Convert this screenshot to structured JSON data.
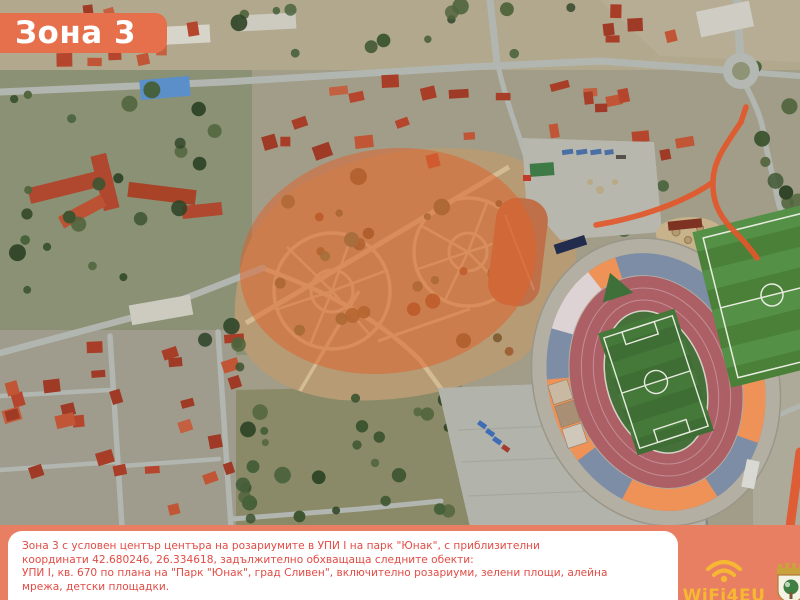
{
  "zone_banner": {
    "label": "Зона 3"
  },
  "caption": {
    "lines": [
      "Зона 3 с условен център центъра на розариумите в УПИ I на парк \"Юнак\", с приблизителни",
      "координати 42.680246, 26.334618, задължително обхващаща следните обекти:",
      "УПИ I, кв. 670 по плана на \"Парк \"Юнак\", град Сливен\", включително розариуми, зелени площи, алейна",
      "мрежа, детски площадки."
    ]
  },
  "footer": {
    "wifi4eu_label": "WiFi4EU"
  },
  "colors": {
    "accent_orange": "#e7704c",
    "footer_orange": "#e87f63",
    "caption_red": "#e24b44",
    "overlay_orange": "#e05f28",
    "wifi_yellow": "#f6b832"
  }
}
